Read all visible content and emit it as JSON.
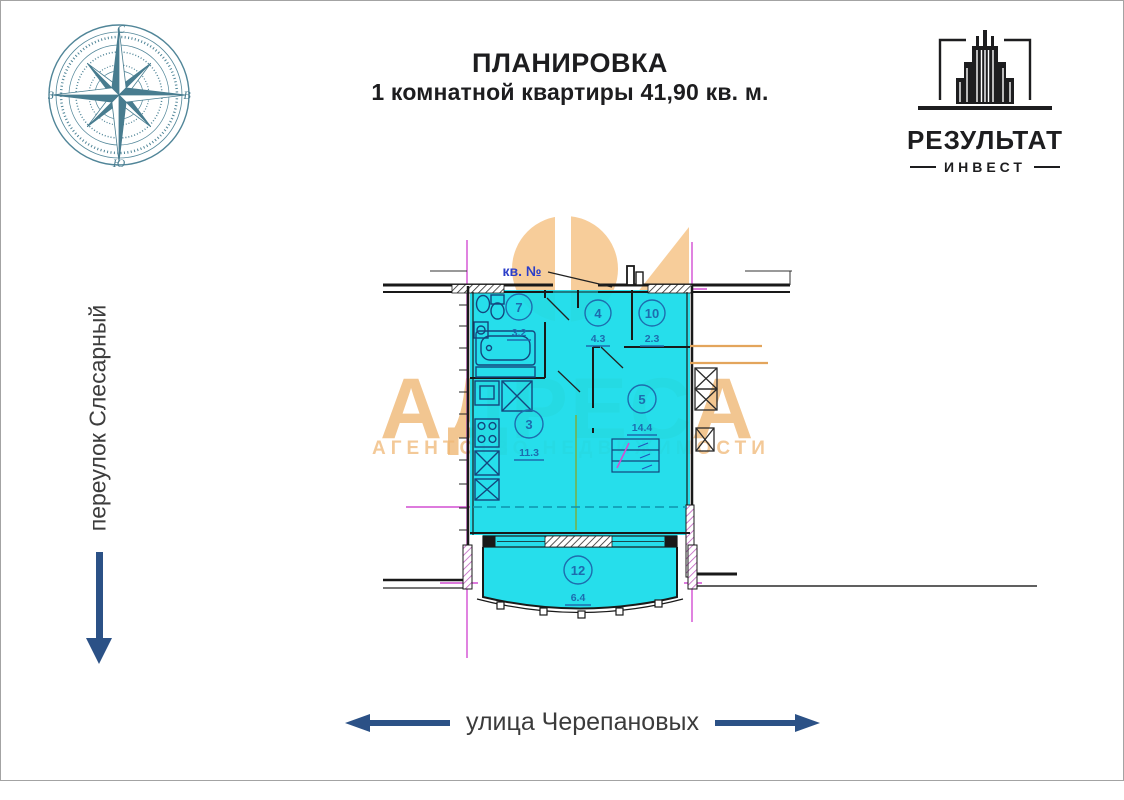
{
  "header": {
    "title_line1": "ПЛАНИРОВКА",
    "title_line2": "1 комнатной квартиры 41,90 кв. м."
  },
  "logo": {
    "title": "РЕЗУЛЬТАТ",
    "subtitle": "ИНВЕСТ"
  },
  "compass": {
    "north": "С",
    "south": "Ю",
    "west": "З",
    "east": "В"
  },
  "streets": {
    "left_label": "переулок Слесарный",
    "bottom_label": "улица Черепановых"
  },
  "watermark": {
    "title": "АДРЕСА",
    "subtitle": "АГЕНТСТВО НЕДВИЖИМОСТИ"
  },
  "floor_plan": {
    "apartment_label": "кв. №",
    "total_area_sqm": "41,90",
    "rooms": [
      {
        "number": "7",
        "area": "3.2"
      },
      {
        "number": "4",
        "area": "4.3"
      },
      {
        "number": "10",
        "area": "2.3"
      },
      {
        "number": "3",
        "area": "11.3"
      },
      {
        "number": "5",
        "area": "14.4"
      },
      {
        "number": "12",
        "area": "6.4"
      }
    ],
    "colors": {
      "fill": "#15dbe9",
      "axis": "#d24ed2",
      "marker": "#1d6cae",
      "wall": "#191919",
      "orange": "#e3a55c",
      "green": "#74b24c",
      "label_blue": "#2b3ec9"
    }
  }
}
